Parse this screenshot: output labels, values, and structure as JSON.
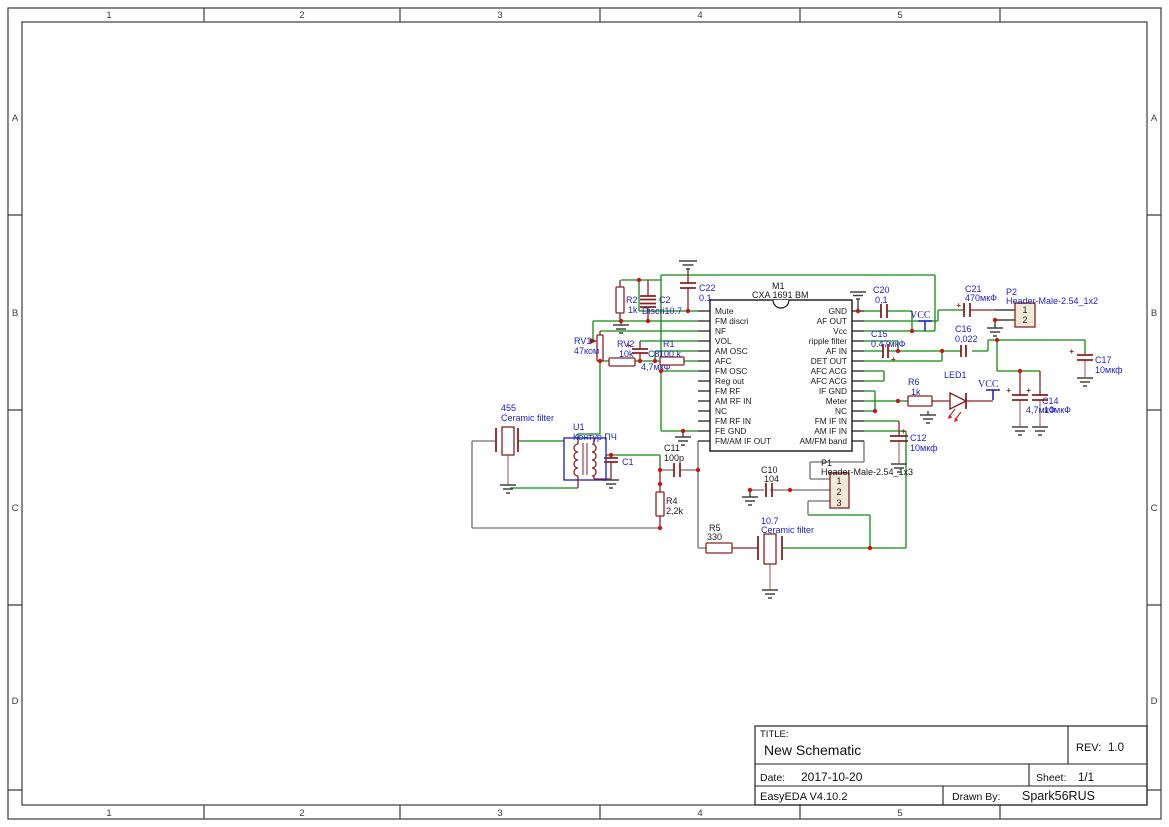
{
  "frame": {
    "columns": [
      "1",
      "2",
      "3",
      "4",
      "5"
    ],
    "rows": [
      "A",
      "B",
      "C",
      "D"
    ]
  },
  "title_block": {
    "title_label": "TITLE:",
    "title": "New Schematic",
    "rev_label": "REV:",
    "rev": "1.0",
    "date_label": "Date:",
    "date": "2017-10-20",
    "sheet_label": "Sheet:",
    "sheet": "1/1",
    "tool_version": "EasyEDA V4.10.2",
    "drawn_by_label": "Drawn By:",
    "drawn_by": "Spark56RUS"
  },
  "ic": {
    "ref": "M1",
    "part": "CXA 1691 BM",
    "left_pins": [
      "Mute",
      "FM discri",
      "NF",
      "VOL",
      "AM OSC",
      "AFC",
      "FM OSC",
      "Reg out",
      "FM RF",
      "AM RF IN",
      "NC",
      "FM RF IN",
      "FE GND",
      "FM/AM IF OUT"
    ],
    "right_pins": [
      "GND",
      "AF OUT",
      "Vcc",
      "ripple filter",
      "AF IN",
      "DET OUT",
      "AFC ACG",
      "AFC ACG",
      "IF GND",
      "Meter",
      "NC",
      "FM IF IN",
      "AM IF IN",
      "AM/FM band"
    ]
  },
  "components": {
    "r2": {
      "name": "R2",
      "value": "1k"
    },
    "c2": {
      "name": "C2",
      "value": "Discri10.7"
    },
    "c22": {
      "name": "C22",
      "value": "0.1"
    },
    "rv1": {
      "name": "RV1",
      "value": "47ком"
    },
    "rv2": {
      "name": "RV2",
      "value": "10k"
    },
    "c8": {
      "name": "C8",
      "value": "4,7мкФ"
    },
    "r1": {
      "name": "R1",
      "value": "100 k"
    },
    "f455": {
      "name": "455",
      "value": "Ceramic filter"
    },
    "u1": {
      "name": "U1",
      "value": "Контур ПЧ"
    },
    "c1": {
      "name": "C1"
    },
    "c11": {
      "name": "C11",
      "value": "100p"
    },
    "r4": {
      "name": "R4",
      "value": "2,2k"
    },
    "r5": {
      "name": "R5",
      "value": "330"
    },
    "f107": {
      "name": "10.7",
      "value": "Ceramic filter"
    },
    "c10": {
      "name": "C10",
      "value": "104"
    },
    "p1": {
      "name": "P1",
      "value": "Header-Male-2.54_1x3",
      "pins": [
        "1",
        "2",
        "3"
      ]
    },
    "c12": {
      "name": "C12",
      "value": "10мкф"
    },
    "c20": {
      "name": "C20",
      "value": "0,1"
    },
    "c15": {
      "name": "C15",
      "value": "0.47мкФ"
    },
    "c16": {
      "name": "C16",
      "value": "0,022"
    },
    "c21": {
      "name": "C21",
      "value": "470мкФ"
    },
    "p2": {
      "name": "P2",
      "value": "Header-Male-2.54_1x2",
      "pins": [
        "1",
        "2"
      ]
    },
    "c17": {
      "name": "C17",
      "value": "10мкф"
    },
    "r6": {
      "name": "R6",
      "value": "1k"
    },
    "led1": {
      "name": "LED1"
    },
    "c13": {
      "value": "4,7мкФ"
    },
    "c14": {
      "name": "C14",
      "value": "10мкФ"
    }
  },
  "power": {
    "vcc": "VCC"
  },
  "symbols": {
    "plus": "+"
  },
  "colors": {
    "wire": "#0f8b0f",
    "component": "#8b2020",
    "label_blue": "#1d1dc4",
    "text_black": "#191919",
    "junction": "#cc1414",
    "gray_wire": "#6f6f6f",
    "pink_lead": "#c98f8f",
    "header_fill": "#f0e9d8",
    "frame_line": "#3c3c3c",
    "led_arrow": "#cc2020"
  }
}
